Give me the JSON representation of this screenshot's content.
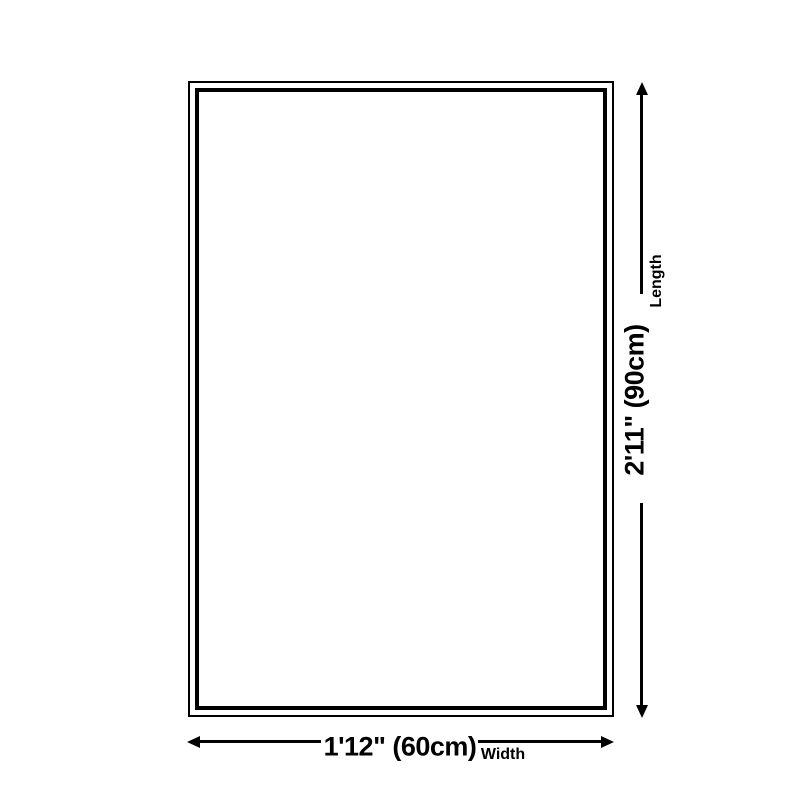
{
  "diagram": {
    "type": "product-dimension-diagram",
    "colors": {
      "background": "#ffffff",
      "line": "#000000",
      "text": "#000000"
    },
    "length": {
      "value": "2'11\" (90cm)",
      "label": "Length"
    },
    "width": {
      "value": "1'12\" (60cm)",
      "label": "Width"
    }
  }
}
